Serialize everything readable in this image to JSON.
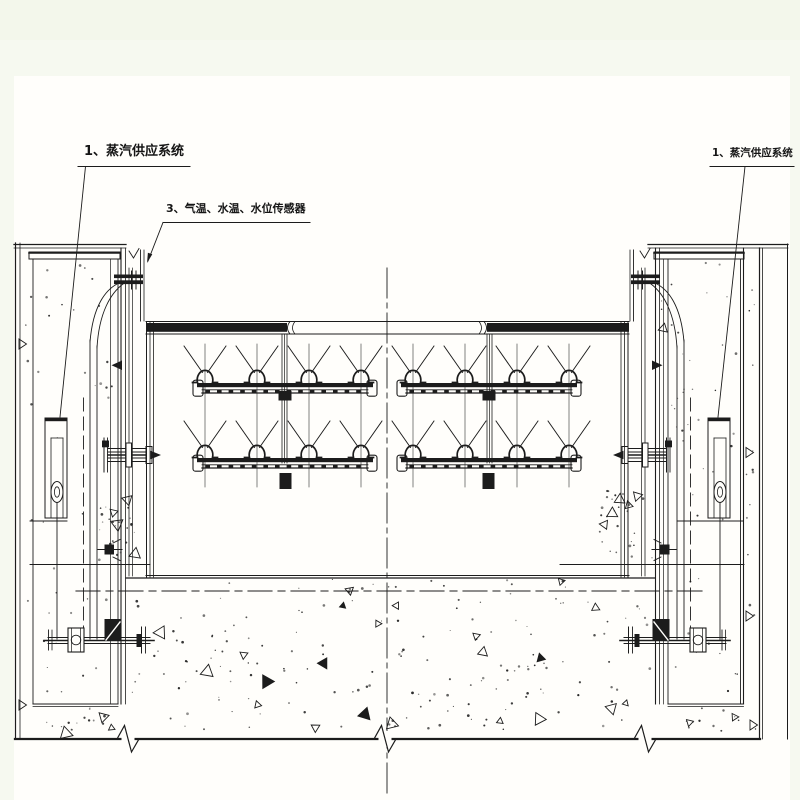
{
  "drawing": {
    "title_hint": "steam supply gate section drawing",
    "labels": {
      "steam_supply_left": "1、蒸汽供应系统",
      "sensors": "3、气温、水温、水位传感器",
      "steam_supply_right": "1、蒸汽供应系统"
    }
  },
  "colors": {
    "ink": "#1c1c1c",
    "paper": "#fffefb",
    "margin": "#f6f9f0",
    "margin_top": "#f3f7eb"
  }
}
